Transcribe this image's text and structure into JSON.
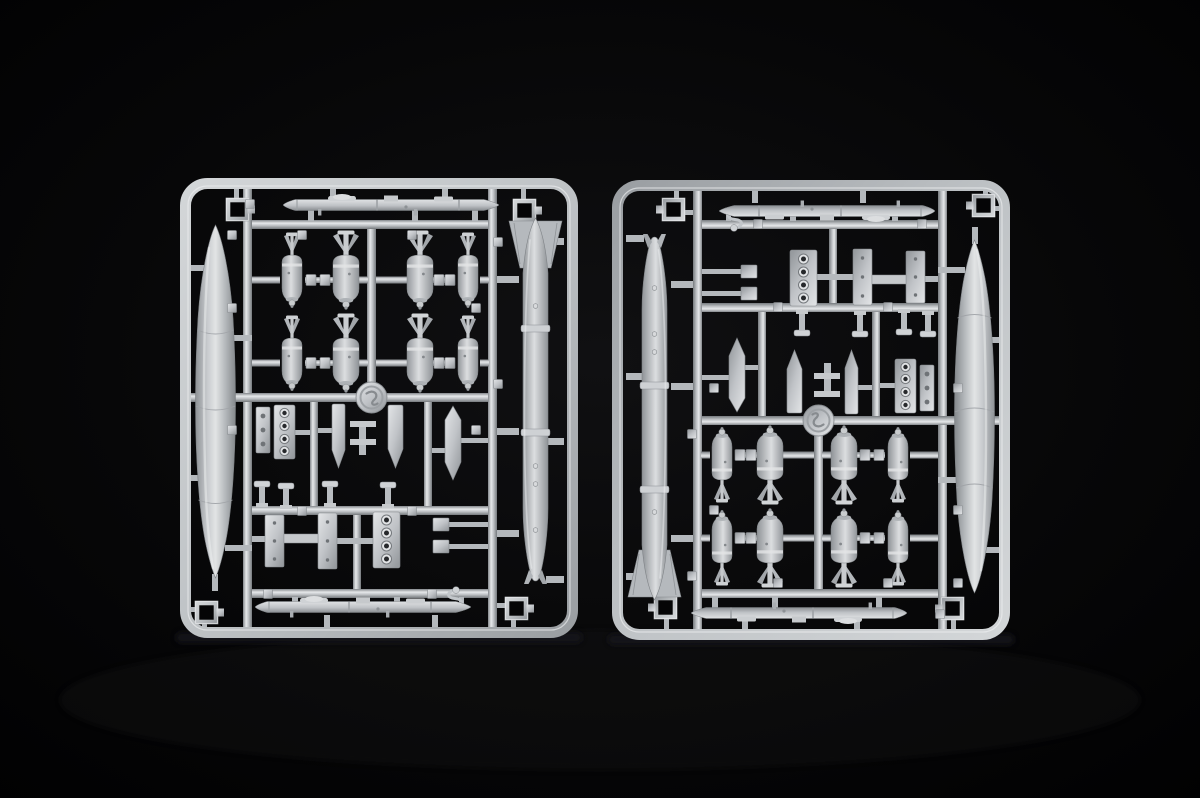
{
  "scene": {
    "media": "photograph",
    "subject": "Two identical light-grey injection-moulded styrene model-kit sprues (runners) holding aircraft ordnance parts - drop-tank halves, finned bombs, slender missiles, bomb racks, pylon brackets - lying side by side on a black studio background. The right sprue is the same moulding rotated 180 degrees.",
    "background_color": "#060607",
    "vignette_center_color": "#101012",
    "plastic_base_color": "#c3c7cb",
    "plastic_highlight_color": "#edeff0",
    "plastic_shadow_color": "#7f8387"
  },
  "sprue_size": {
    "width": 398,
    "height": 460
  },
  "sprues": [
    {
      "id": "left-sprue",
      "x": 180,
      "y": 178,
      "rotation": 0
    },
    {
      "id": "right-sprue",
      "x": 612,
      "y": 180,
      "rotation": 180
    }
  ],
  "template": {
    "bombs": {
      "rows": [
        102,
        185
      ],
      "columns": [
        {
          "x": 112,
          "variant": "slim"
        },
        {
          "x": 166,
          "variant": "fat"
        },
        {
          "x": 240,
          "variant": "fat"
        },
        {
          "x": 288,
          "variant": "slim"
        }
      ],
      "pair_links": [
        {
          "x1": 125,
          "x2": 153
        },
        {
          "x1": 253,
          "x2": 275
        }
      ],
      "rail_stubs": [
        {
          "x1": 72,
          "x2": 100
        },
        {
          "x1": 178,
          "x2": 188
        },
        {
          "x1": 196,
          "x2": 228
        },
        {
          "x1": 300,
          "x2": 309
        }
      ]
    },
    "missiles": [
      {
        "x": 108,
        "y": 27
      },
      {
        "x": 80,
        "y": 429
      }
    ],
    "number_tabs": [
      [
        52,
        57
      ],
      [
        122,
        57
      ],
      [
        232,
        57
      ],
      [
        52,
        130
      ],
      [
        296,
        130
      ],
      [
        52,
        252
      ],
      [
        296,
        252
      ],
      [
        122,
        333
      ],
      [
        232,
        333
      ],
      [
        88,
        416
      ],
      [
        252,
        416
      ],
      [
        70,
        26
      ],
      [
        318,
        206
      ],
      [
        318,
        64
      ]
    ]
  },
  "inventory_per_sprue": [
    {
      "part": "drop-tank-half",
      "qty": 1
    },
    {
      "part": "large-tail-finned-bomb",
      "qty": 1
    },
    {
      "part": "small-finned-bomb",
      "qty": 8
    },
    {
      "part": "slender-missile",
      "qty": 2
    },
    {
      "part": "four-hole-bomb-rack",
      "qty": 2
    },
    {
      "part": "drilled-bracket-plate",
      "qty": 3
    },
    {
      "part": "pylon-blade",
      "qty": 3
    },
    {
      "part": "sway-brace-plate",
      "qty": 8
    },
    {
      "part": "mounting-post",
      "qty": 4
    },
    {
      "part": "corner-clip",
      "qty": 4
    },
    {
      "part": "crank-lever",
      "qty": 1
    },
    {
      "part": "moulding-emblem",
      "qty": 1
    }
  ]
}
